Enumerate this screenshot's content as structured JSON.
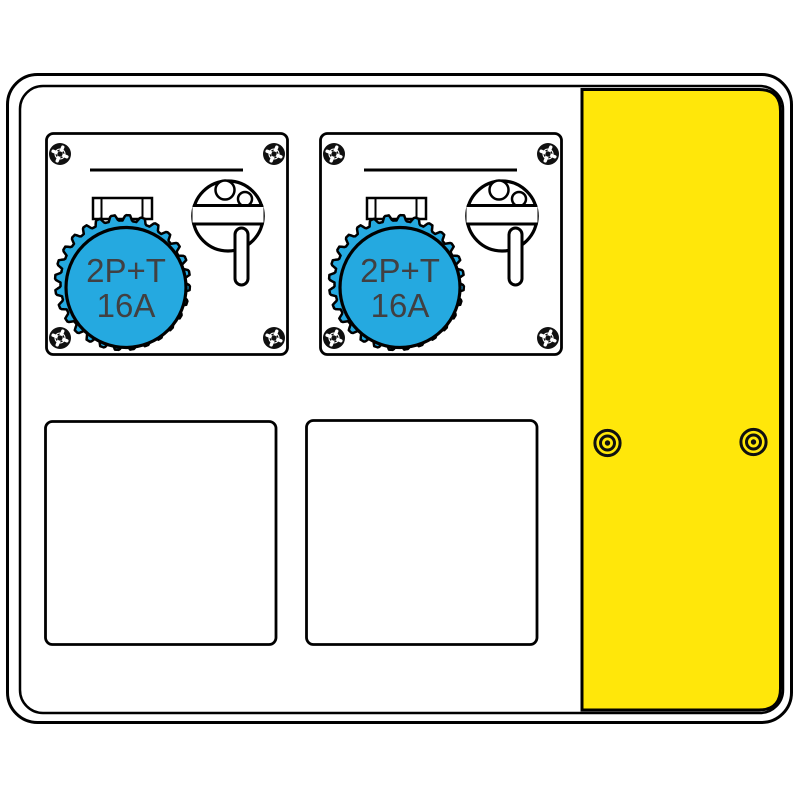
{
  "modules": [
    {
      "rating_line1": "2P+T",
      "rating_line2": "16A"
    },
    {
      "rating_line1": "2P+T",
      "rating_line2": "16A"
    }
  ],
  "colors": {
    "socket_blue": "#25A9E0",
    "panel_yellow": "#FFE70A",
    "outline": "#000000",
    "label": "#414042",
    "background": "#FFFFFF"
  }
}
